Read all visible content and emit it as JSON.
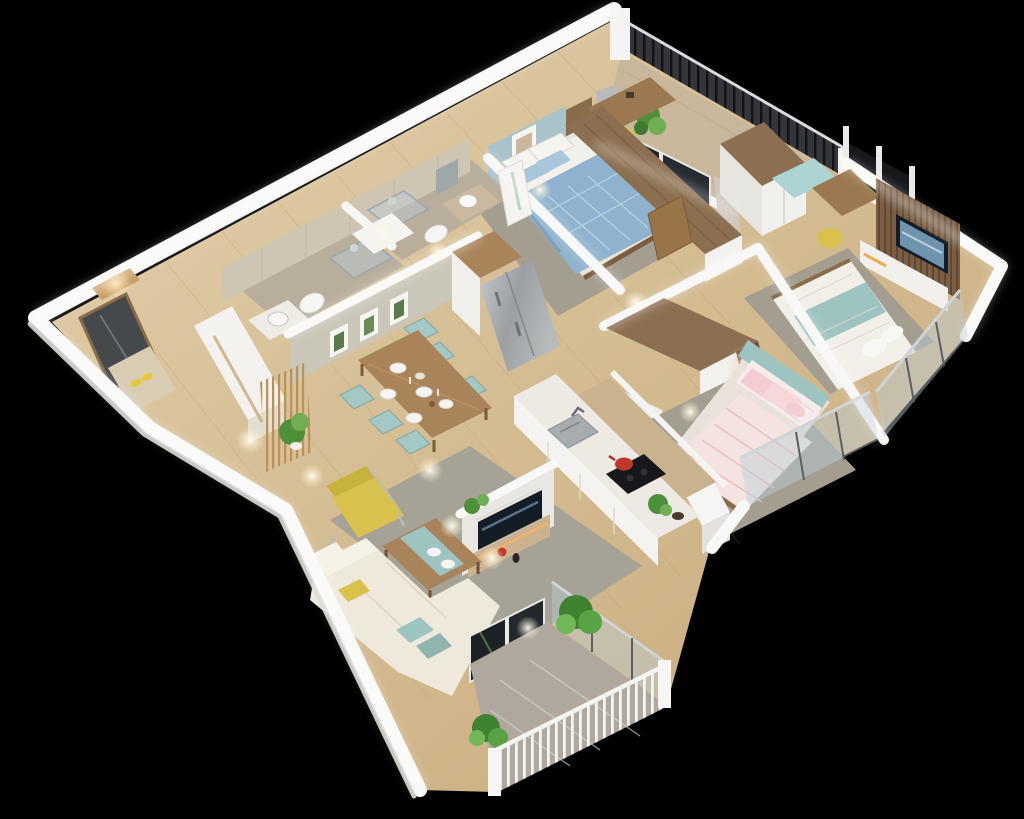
{
  "scene": {
    "title": "3d-apartment-floor-plan-render",
    "style": "isometric-cutaway-3d-render",
    "background": "#000000",
    "width": 1024,
    "height": 819
  },
  "palette": {
    "wallTop": "#f8f8f6",
    "wallFace": "#eceae6",
    "woodFloorA": "#e0cda8",
    "woodFloorB": "#c39f72",
    "woodFurniture": "#a9845a",
    "woodDark": "#8a6b4a",
    "woodDesk": "#9b7850",
    "closetTop": "#8b6f50",
    "tileBath": "#b9ae9c",
    "marbleWall": "#cfc5b3",
    "tileBalconyTop": "#c9b79c",
    "tileBalconyLiving": "#b0a89f",
    "railingDark": "#34363c",
    "rugGray": "#a39e90",
    "rugLiving": "#a6a296",
    "blueWall": "#a9c3cb",
    "duvetBlue": "#8fb3ce",
    "pillowBlue": "#a7c6da",
    "tealChair": "#a3c8c6",
    "tealCushion": "#9dc4c0",
    "tealSeat": "#abd4d2",
    "pinkDuvet": "#f5e3e1",
    "pinkPillow": "#f3cdd1",
    "tealHeadboard": "#9dc4c0",
    "yellowAccent": "#d9c14e",
    "creamSofa": "#efe9dc",
    "marbleCounter": "#eceae2",
    "steelAppliance": "#aab0b2",
    "glassTint": "rgba(186,205,214,0.45)",
    "tvDark": "#141c26",
    "tvImage": "#6f94ad",
    "plantGreen": "#4e8f3a",
    "plantLight": "#6fae53",
    "wallpaper": "#cac6b8",
    "windowDark": "#17181c",
    "warmGlow": "#e8b254",
    "slatWall": "#7b5f45",
    "matBeige": "#d8cdb2",
    "redPot": "#c0392b"
  },
  "rooms": [
    {
      "id": "entrance",
      "label": "Entrance Hall",
      "items": [
        "mirror-wardrobe",
        "doormat",
        "yellow-slippers",
        "shoe-cabinet",
        "gold-slat-partition",
        "potted-fern"
      ]
    },
    {
      "id": "bathroom-1",
      "label": "Bathroom 1",
      "items": [
        "washbasin",
        "wall-hung-toilet",
        "walk-in-shower"
      ]
    },
    {
      "id": "bathroom-2",
      "label": "Bathroom 2",
      "items": [
        "washbasin",
        "mirror",
        "wall-hung-toilet",
        "walk-in-shower",
        "white-door"
      ]
    },
    {
      "id": "bedroom-1",
      "label": "Bedroom 1",
      "items": [
        "blue-accent-wall",
        "deer-wall-art",
        "double-bed-blue-plaid",
        "white-pillows",
        "blue-pillows",
        "wood-headboard",
        "dresser-desk",
        "yellow-stool",
        "gray-rug",
        "gray-curtain",
        "sliding-glass-door"
      ]
    },
    {
      "id": "balcony-1",
      "label": "Bedroom Balcony",
      "items": [
        "dark-metal-railing",
        "tile-floor",
        "climbing-plant",
        "curtains",
        "corner-posts"
      ]
    },
    {
      "id": "bedroom-2",
      "label": "Bedroom 2",
      "items": [
        "wardrobe",
        "bay-window",
        "window-seat-teal",
        "desk",
        "yellow-stool",
        "tv-slat-wall",
        "wall-tv",
        "media-cabinet",
        "bed-white-teal",
        "gray-rug",
        "glass-balustrade"
      ]
    },
    {
      "id": "master-bedroom",
      "label": "Master Bedroom",
      "items": [
        "l-wardrobe",
        "open-shelf-warm-light",
        "bedside-lamp-pink-glow",
        "double-bed-pink",
        "teal-headboard",
        "pink-pillows",
        "gray-rug",
        "glass-balustrade"
      ]
    },
    {
      "id": "kitchen",
      "label": "Kitchen",
      "items": [
        "tall-cabinet",
        "refrigerator",
        "island-counter",
        "double-sink",
        "cooktop",
        "red-pot",
        "herb-plant",
        "back-counter"
      ]
    },
    {
      "id": "dining",
      "label": "Dining Area",
      "items": [
        "wood-dining-table",
        "teal-chairs-x6",
        "plates",
        "glasses",
        "botanical-art-x3",
        "wallpaper-wall"
      ]
    },
    {
      "id": "living",
      "label": "Living Room",
      "items": [
        "marble-tv-wall",
        "wall-tv",
        "media-console",
        "red-vase",
        "plants",
        "yellow-armchair",
        "coffee-table-teal-runner",
        "corner-sofa-cream",
        "teal-cushions",
        "yellow-cushion",
        "gray-rug"
      ]
    },
    {
      "id": "balcony-2",
      "label": "Living Balcony",
      "items": [
        "glass-sliding-doors",
        "glossy-tile-floor",
        "white-baluster-railing",
        "glass-balustrade",
        "green-shrubs-x2"
      ]
    }
  ],
  "lighting": {
    "ceiling_spot_reflections": 10,
    "wall_bloom": "white",
    "door_glow": 2
  }
}
